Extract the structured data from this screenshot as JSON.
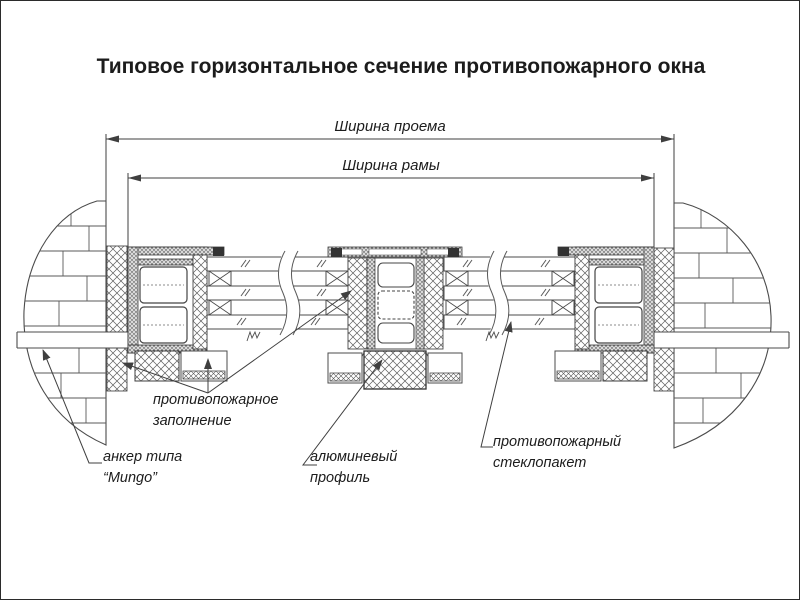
{
  "title": "Типовое горизонтальное сечение противопожарного окна",
  "dimensions": {
    "opening_width": "Ширина проема",
    "frame_width": "Ширина рамы"
  },
  "annotations": {
    "fire_filling": "противопожарное\nзаполнение",
    "anchor": "анкер типа\n“Mungo”",
    "aluminum_profile": "алюминевый\nпрофиль",
    "fire_glazing": "противопожарный\nстеклопакет"
  },
  "colors": {
    "background": "#ffffff",
    "line": "#4b4b4b",
    "dimension_line": "#3f3f3f",
    "text": "#1c1c1c",
    "profile_fill": "#d9d9d9",
    "dark_block": "#333333"
  }
}
